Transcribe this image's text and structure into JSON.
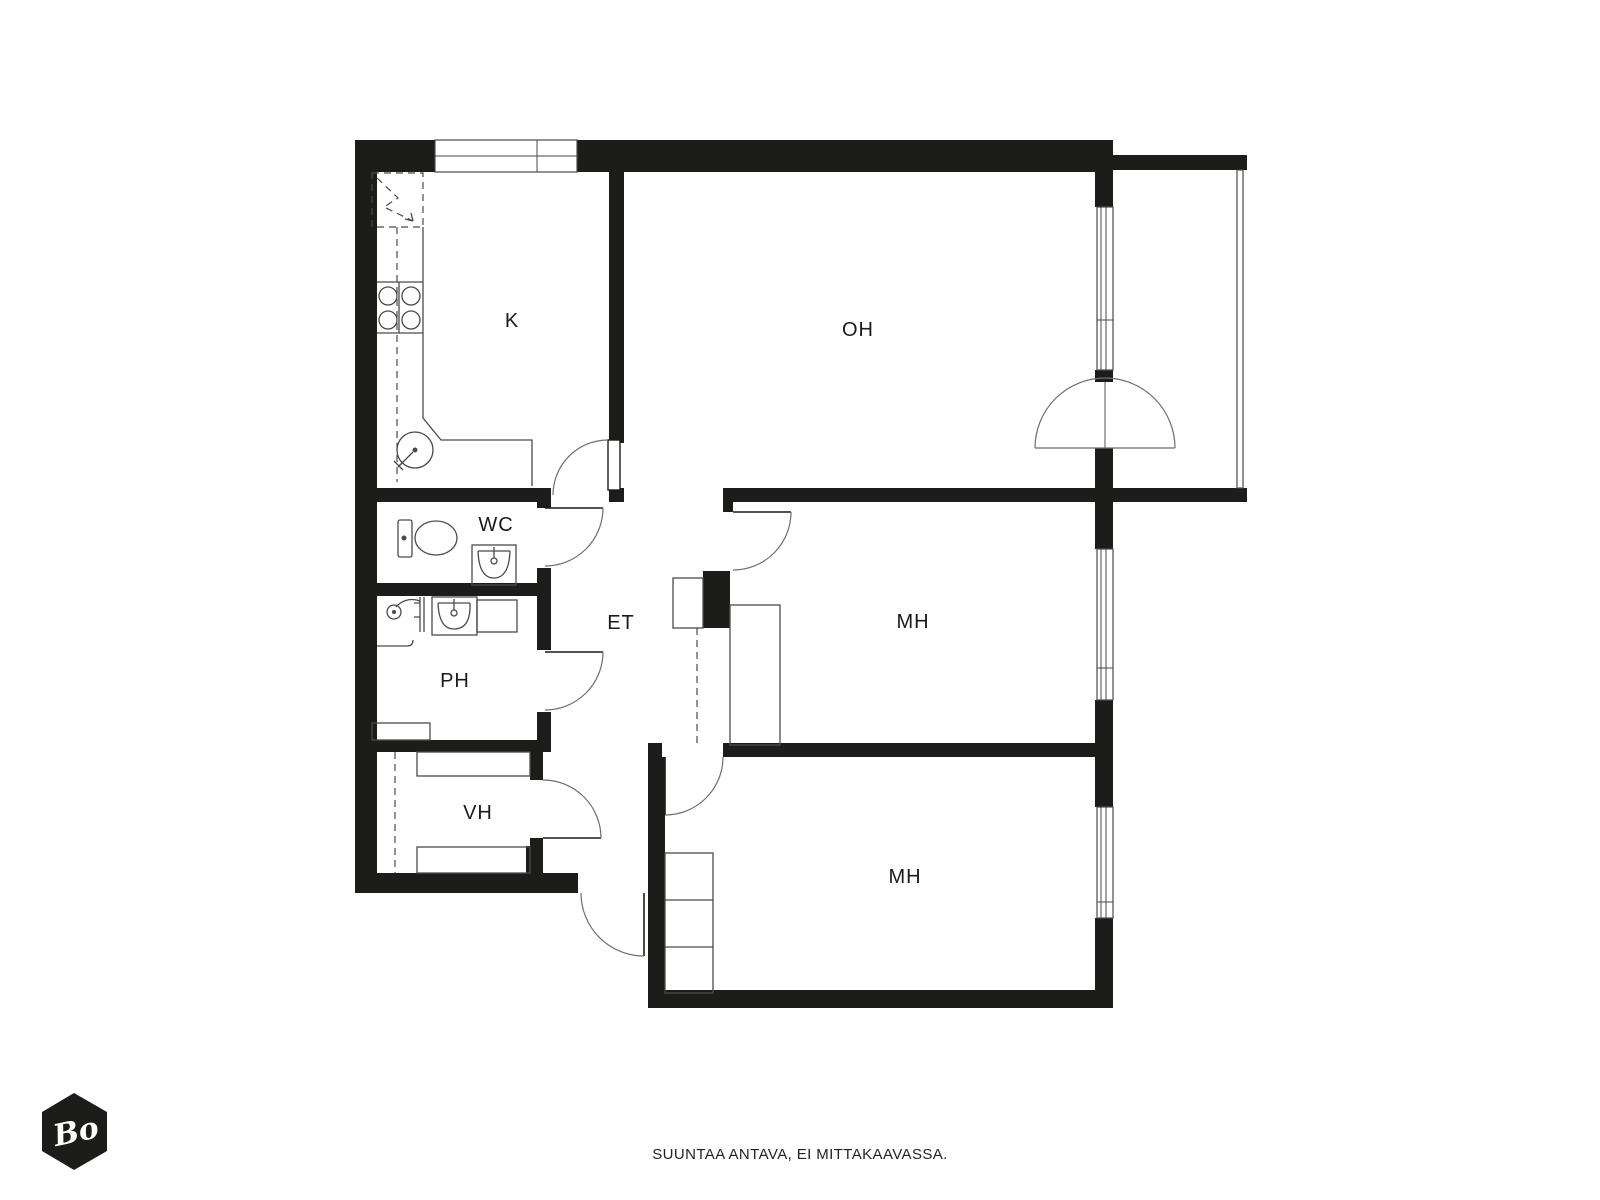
{
  "document": {
    "footer_text": "SUUNTAA ANTAVA, EI MITTAKAAVASSA.",
    "logo": {
      "text": "Bo",
      "shape": "hexagon"
    }
  },
  "floor_plan": {
    "colors": {
      "background": "#ffffff",
      "wall": "#1c1c1a",
      "line": "#4a4a4a",
      "arc": "#6e6e6e",
      "label": "#1a1a1a",
      "logo-bg": "#1c1c1a",
      "logo-text": "#ffffff"
    },
    "rooms": [
      {
        "id": "kitchen",
        "label": "K"
      },
      {
        "id": "living-room",
        "label": "OH"
      },
      {
        "id": "wc",
        "label": "WC"
      },
      {
        "id": "hallway",
        "label": "ET"
      },
      {
        "id": "washroom",
        "label": "PH"
      },
      {
        "id": "bedroom-1",
        "label": "MH"
      },
      {
        "id": "walk-in-closet",
        "label": "VH"
      },
      {
        "id": "bedroom-2",
        "label": "MH"
      }
    ],
    "fixtures": [
      "refrigerator-reservation-icon",
      "stove-icon",
      "kitchen-sink-icon",
      "kitchen-counter",
      "toilet-icon",
      "washbasin-icon",
      "shower-icon",
      "wardrobe",
      "shelf-closet",
      "window",
      "balcony-railing",
      "door-swing-arc",
      "balcony-double-door"
    ]
  }
}
